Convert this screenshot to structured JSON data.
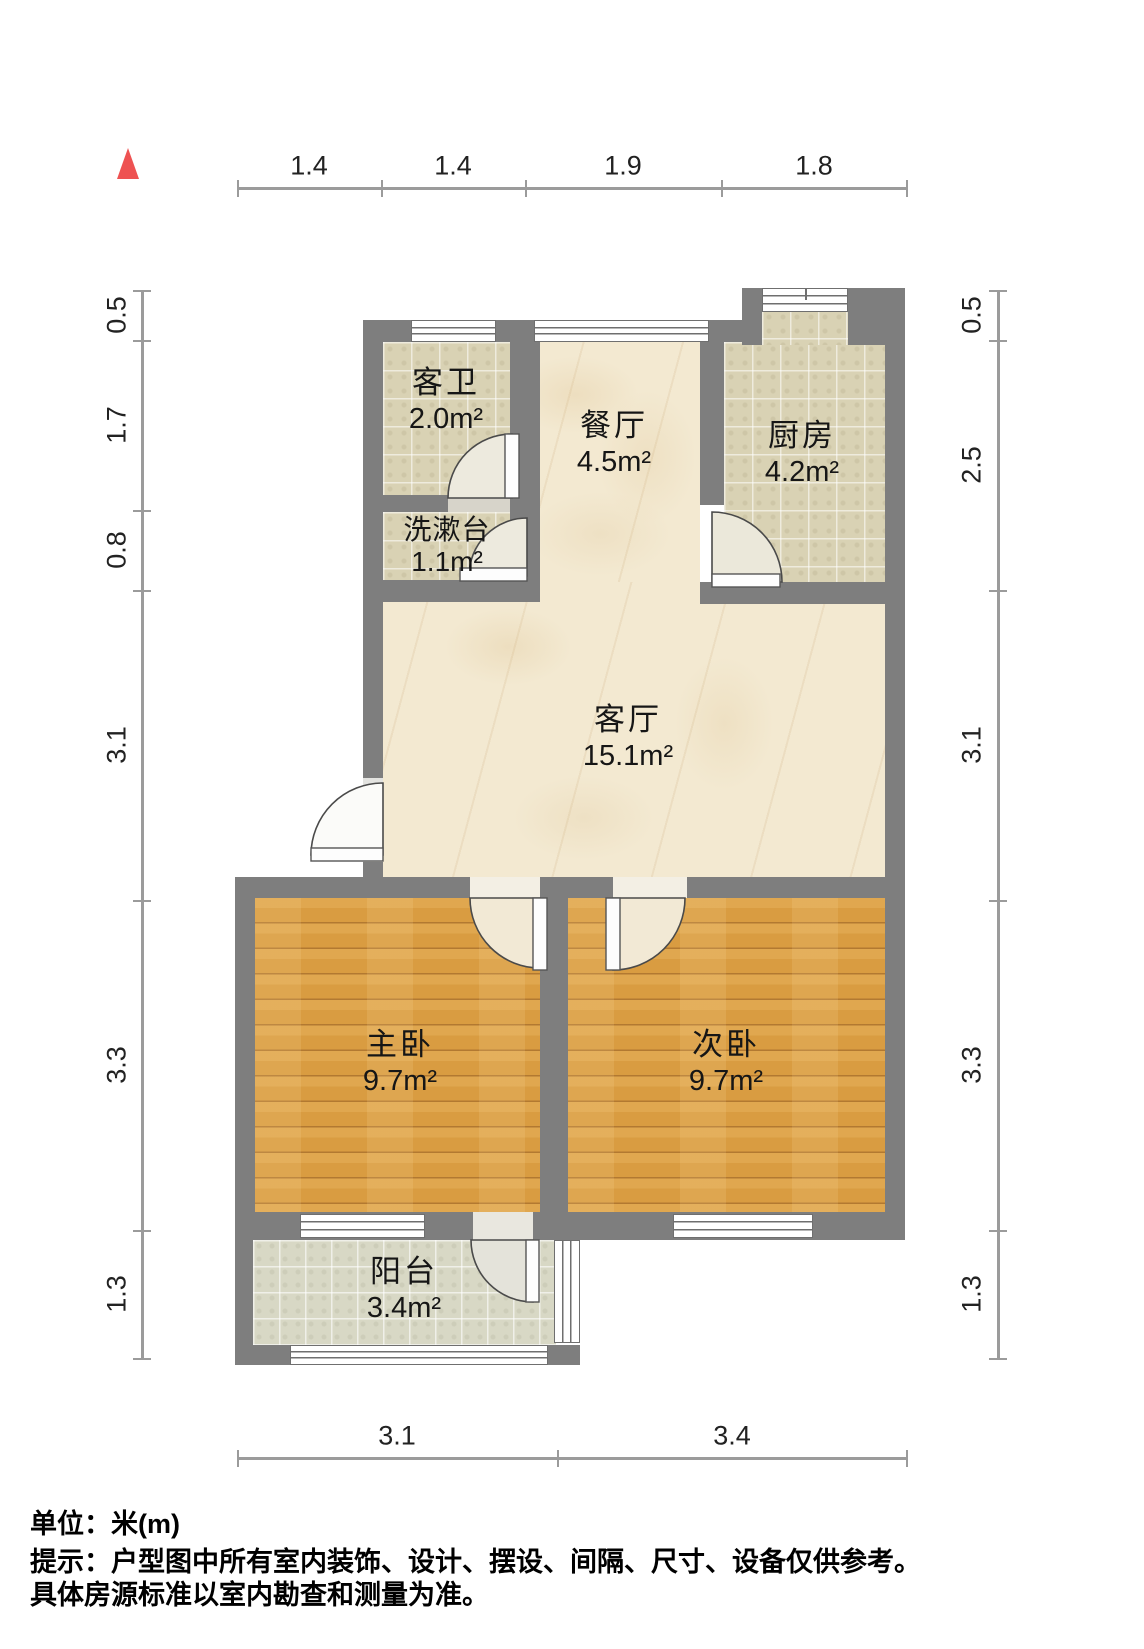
{
  "rooms": {
    "guest_bath": {
      "name": "客卫",
      "area": "2.0m²"
    },
    "washstand": {
      "name": "洗漱台",
      "area": "1.1m²"
    },
    "dining": {
      "name": "餐厅",
      "area": "4.5m²"
    },
    "kitchen": {
      "name": "厨房",
      "area": "4.2m²"
    },
    "living": {
      "name": "客厅",
      "area": "15.1m²"
    },
    "master_bedroom": {
      "name": "主卧",
      "area": "9.7m²"
    },
    "second_bedroom": {
      "name": "次卧",
      "area": "9.7m²"
    },
    "balcony": {
      "name": "阳台",
      "area": "3.4m²"
    }
  },
  "dimensions": {
    "unit": "m",
    "top": [
      "1.4",
      "1.4",
      "1.9",
      "1.8"
    ],
    "bottom": [
      "3.1",
      "3.4"
    ],
    "left": [
      "0.5",
      "1.7",
      "0.8",
      "3.1",
      "3.3",
      "1.3"
    ],
    "right": [
      "0.5",
      "2.5",
      "3.1",
      "3.3",
      "1.3"
    ]
  },
  "footer": {
    "unit_label": "单位：米(m)",
    "disclaimer_line1": "提示：户型图中所有室内装饰、设计、摆设、间隔、尺寸、设备仅供参考。",
    "disclaimer_line2": "具体房源标准以室内勘查和测量为准。"
  },
  "colors": {
    "wall": "#7e7e7e",
    "wood_floor": "#dca14b",
    "tile_floor": "#d9d2b4",
    "marble_floor": "#f3e9d1",
    "balcony_floor": "#d8d8c5",
    "dimension_line": "#9b9b9b",
    "north_arrow": "#ee5252"
  }
}
